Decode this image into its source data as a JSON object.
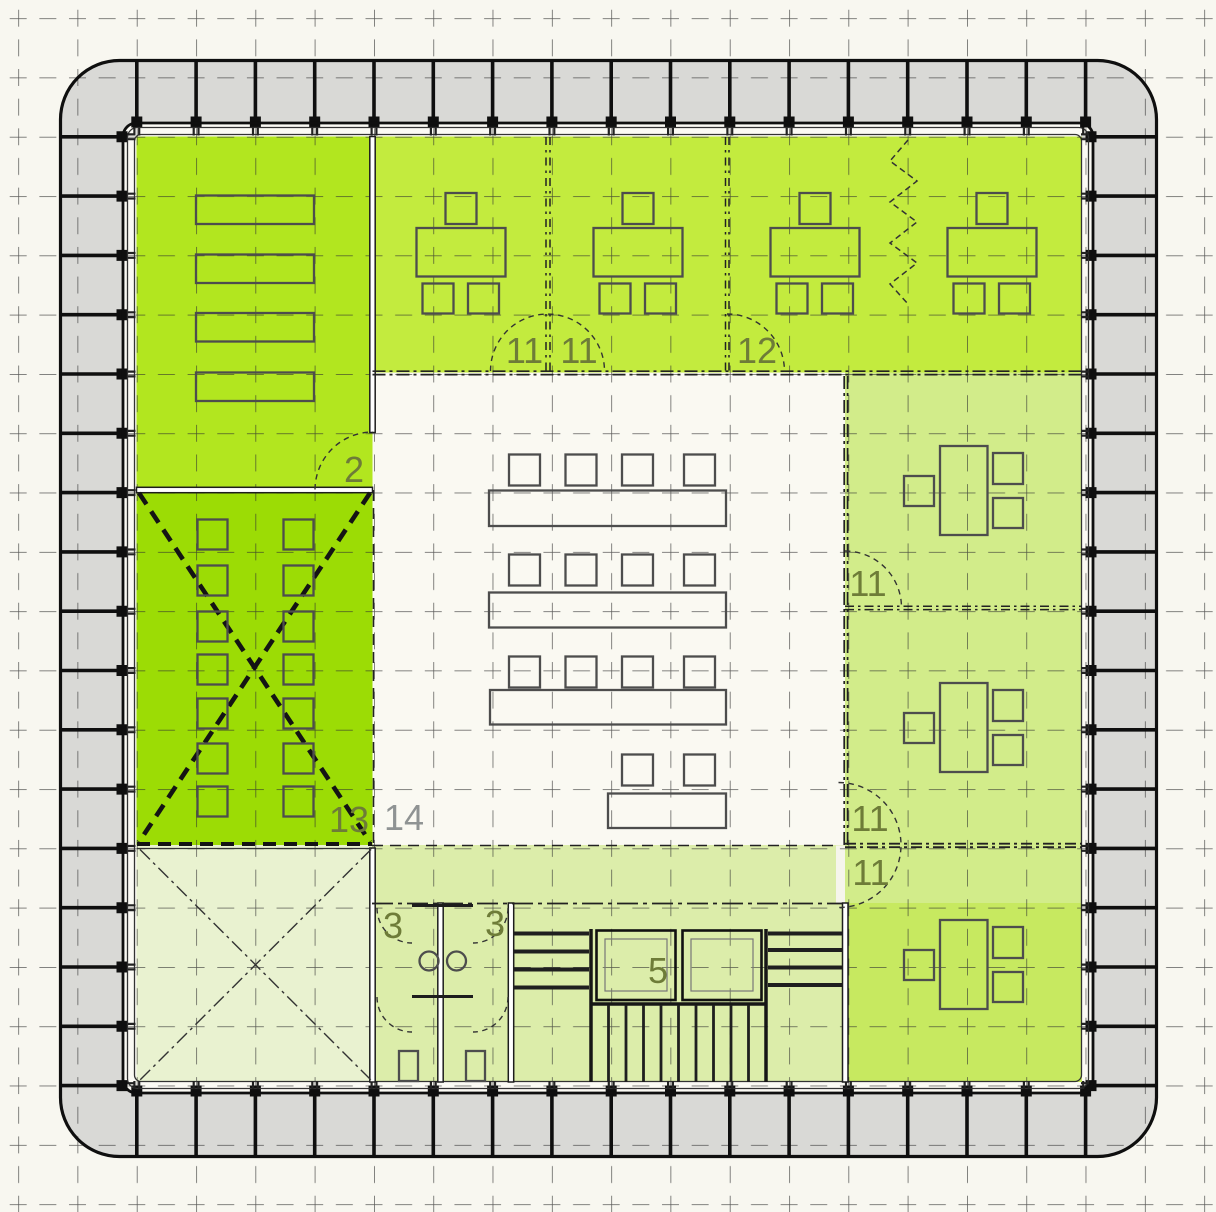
{
  "labels": [
    {
      "id": "room-11-north-a",
      "text": "11"
    },
    {
      "id": "room-11-north-b",
      "text": "11"
    },
    {
      "id": "room-12-north",
      "text": "12"
    },
    {
      "id": "room-2-west",
      "text": "2"
    },
    {
      "id": "room-11-east-mid",
      "text": "11"
    },
    {
      "id": "room-13-west",
      "text": "13"
    },
    {
      "id": "room-14-center",
      "text": "14"
    },
    {
      "id": "room-11-east-a",
      "text": "11"
    },
    {
      "id": "room-11-east-b",
      "text": "11"
    },
    {
      "id": "room-3-wc-a",
      "text": "3"
    },
    {
      "id": "room-3-wc-b",
      "text": "3"
    },
    {
      "id": "room-5-lift",
      "text": "5"
    }
  ],
  "colors": {
    "canvas": "#f8f7f0",
    "facade_gray": "#d9d9d6",
    "facade_inner_gap": "#fbfaf4",
    "room_top_left": "#b2e61f",
    "room_top_band": "#c3eb3e",
    "room_meeting_x": "#9cdc05",
    "room_right_upper": "#d2ec8a",
    "room_right_lower": "#c7e960",
    "room_service_band": "#dcedaa",
    "room_bottom_left": "#e9f2d0",
    "room_center": "#faf9f2",
    "door_gap": "#f6f5ec",
    "label_olive": "#6e7c38",
    "label_gray": "#8f9393"
  }
}
